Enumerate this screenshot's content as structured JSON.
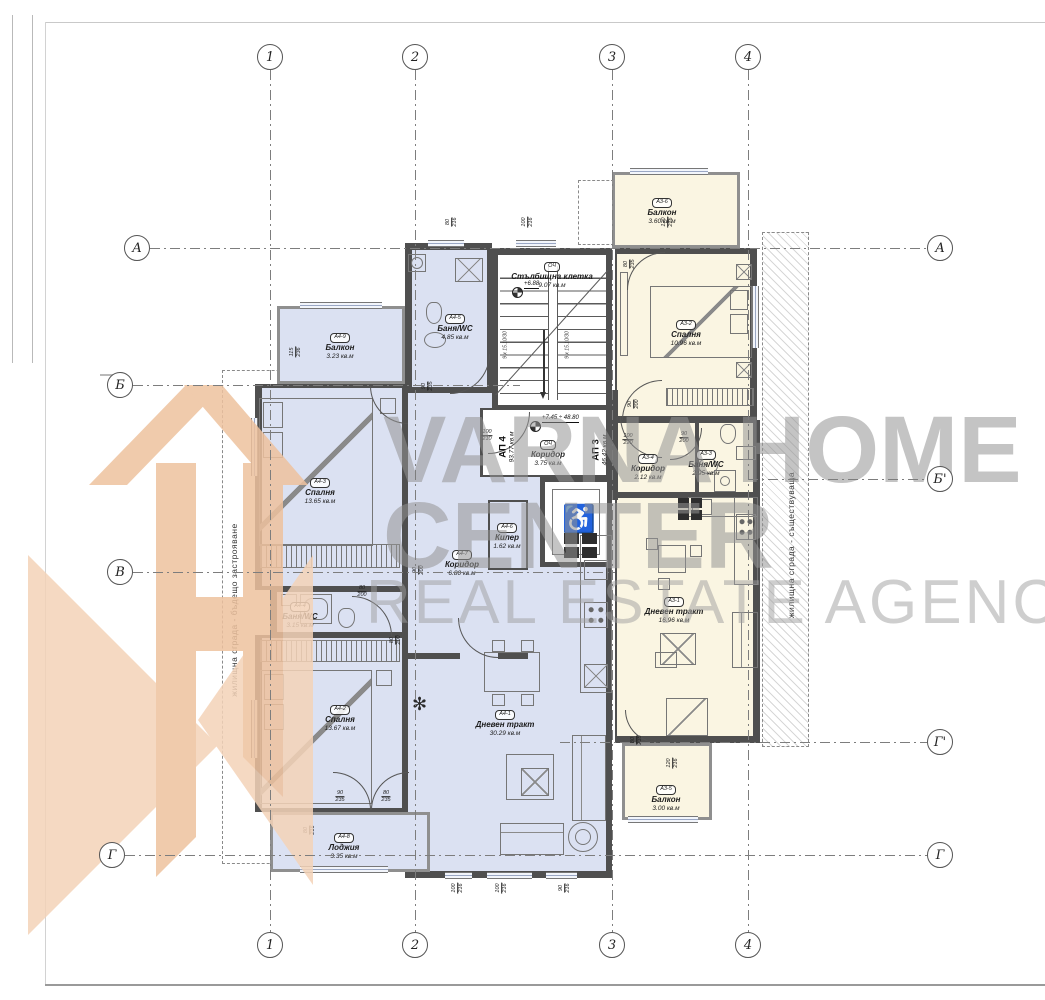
{
  "watermark": {
    "line1": "VARNA HOME",
    "line2": "CENTER",
    "line3": "REAL ESTATE AGENCY",
    "text_color": "#949494",
    "logo_color_light": "#f4d3b8",
    "logo_color_dark": "#eec29e"
  },
  "side_labels": {
    "left": "жилищна сграда - бъдещо застрояване",
    "right": "жилищна сграда - съществуваща"
  },
  "grid": {
    "cols": [
      {
        "label": "1",
        "x": 270
      },
      {
        "label": "2",
        "x": 415
      },
      {
        "label": "3",
        "x": 612
      },
      {
        "label": "4",
        "x": 748
      }
    ],
    "rows": [
      {
        "label": "А",
        "y": 248,
        "x1": 150,
        "x2": 927,
        "left": true,
        "right": true
      },
      {
        "label": "Б",
        "y": 385,
        "x1": 133,
        "x2": 520,
        "left": true,
        "right": false
      },
      {
        "label": "Б'",
        "y": 479,
        "x1": 748,
        "x2": 927,
        "left": false,
        "right": true
      },
      {
        "label": "В",
        "y": 572,
        "x1": 133,
        "x2": 615,
        "left": true,
        "right": false
      },
      {
        "label": "Г'",
        "y": 742,
        "x1": 560,
        "x2": 927,
        "left": false,
        "right": true
      },
      {
        "label": "Г",
        "y": 855,
        "x1": 125,
        "x2": 927,
        "left": true,
        "right": true
      }
    ]
  },
  "apartments": [
    {
      "id": "АП 4",
      "area": "93.77 кв.м",
      "x": 507,
      "y": 447
    },
    {
      "id": "АП 3",
      "area": "46.42 кв.м",
      "x": 600,
      "y": 450
    }
  ],
  "rooms": [
    {
      "code": "А4-5",
      "name": "Баня/WC",
      "area": "4.85 кв.м",
      "cx": 455,
      "cy": 306
    },
    {
      "code": "ОЧ",
      "name": "Стълбищна клетка",
      "area": "9.07 кв.м",
      "cx": 552,
      "cy": 254
    },
    {
      "code": "А3-6",
      "name": "Балкон",
      "area": "3.60 кв.м",
      "cx": 662,
      "cy": 190
    },
    {
      "code": "А3-2",
      "name": "Спалня",
      "area": "10.96 кв.м",
      "cx": 686,
      "cy": 312
    },
    {
      "code": "А4-9",
      "name": "Балкон",
      "area": "3.23 кв.м",
      "cx": 340,
      "cy": 325
    },
    {
      "code": "А4-3",
      "name": "Спалня",
      "area": "13.65 кв.м",
      "cx": 320,
      "cy": 470
    },
    {
      "code": "ОЧ",
      "name": "Коридор",
      "area": "3.75 кв.м",
      "cx": 548,
      "cy": 432
    },
    {
      "code": "А3-4",
      "name": "Коридор",
      "area": "2.12 кв.м",
      "cx": 648,
      "cy": 446
    },
    {
      "code": "А3-3",
      "name": "Баня/WC",
      "area": "2.95 кв.м",
      "cx": 706,
      "cy": 442
    },
    {
      "code": "А4-7",
      "name": "Коридор",
      "area": "6.80 кв.м",
      "cx": 462,
      "cy": 542
    },
    {
      "code": "А4-6",
      "name": "Килер",
      "area": "1.62 кв.м",
      "cx": 507,
      "cy": 515
    },
    {
      "code": "А3-1",
      "name": "Дневен тракт",
      "area": "16.96 кв.м",
      "cx": 674,
      "cy": 589
    },
    {
      "code": "А4-4",
      "name": "Баня/WC",
      "area": "3.15 кв.м",
      "cx": 300,
      "cy": 594
    },
    {
      "code": "А4-2",
      "name": "Спалня",
      "area": "13.67 кв.м",
      "cx": 340,
      "cy": 697
    },
    {
      "code": "А4-1",
      "name": "Дневен тракт",
      "area": "30.29 кв.м",
      "cx": 505,
      "cy": 702
    },
    {
      "code": "А4-8",
      "name": "Лоджия",
      "area": "3.35 кв.м",
      "cx": 344,
      "cy": 825
    },
    {
      "code": "А3-5",
      "name": "Балкон",
      "area": "3.00 кв.м",
      "cx": 666,
      "cy": 777
    }
  ],
  "dims": [
    {
      "t": "80",
      "b": "216",
      "x": 452,
      "y": 222,
      "r": -90
    },
    {
      "t": "100",
      "b": "216",
      "x": 528,
      "y": 222,
      "r": -90
    },
    {
      "t": "120",
      "b": "216",
      "x": 668,
      "y": 222,
      "r": -90
    },
    {
      "t": "80",
      "b": "235",
      "x": 630,
      "y": 264,
      "r": -90
    },
    {
      "t": "115",
      "b": "236",
      "x": 296,
      "y": 352,
      "r": -90
    },
    {
      "t": "90",
      "b": "235",
      "x": 428,
      "y": 386,
      "r": -90
    },
    {
      "t": "100",
      "b": "210",
      "x": 487,
      "y": 436,
      "r": 0
    },
    {
      "t": "100",
      "b": "220",
      "x": 628,
      "y": 440,
      "r": 0
    },
    {
      "t": "90",
      "b": "200",
      "x": 684,
      "y": 438,
      "r": 0
    },
    {
      "t": "90",
      "b": "200",
      "x": 634,
      "y": 404,
      "r": -90
    },
    {
      "t": "90",
      "b": "200",
      "x": 419,
      "y": 570,
      "r": -90
    },
    {
      "t": "80",
      "b": "200",
      "x": 362,
      "y": 592,
      "r": 0
    },
    {
      "t": "80",
      "b": "200",
      "x": 396,
      "y": 640,
      "r": -90
    },
    {
      "t": "90",
      "b": "235",
      "x": 340,
      "y": 797,
      "r": 0
    },
    {
      "t": "80",
      "b": "235",
      "x": 386,
      "y": 797,
      "r": 0
    },
    {
      "t": "80",
      "b": "216",
      "x": 310,
      "y": 830,
      "r": -90
    },
    {
      "t": "100",
      "b": "216",
      "x": 458,
      "y": 888,
      "r": -90
    },
    {
      "t": "100",
      "b": "216",
      "x": 502,
      "y": 888,
      "r": -90
    },
    {
      "t": "90",
      "b": "216",
      "x": 565,
      "y": 888,
      "r": -90
    },
    {
      "t": "120",
      "b": "216",
      "x": 673,
      "y": 763,
      "r": -90
    },
    {
      "t": "80",
      "b": "235",
      "x": 637,
      "y": 740,
      "r": -90
    }
  ],
  "stairs": {
    "note": "9 х 15.10/30",
    "notes_pos": [
      {
        "x": 506,
        "y": 345
      },
      {
        "x": 568,
        "y": 345
      }
    ]
  },
  "levels": [
    {
      "text": "+6.88",
      "tx": 524,
      "ty": 281,
      "mx": 512,
      "my": 287
    },
    {
      "text": "+7.45 ÷ 48.80",
      "tx": 542,
      "ty": 415,
      "mx": 530,
      "my": 421
    }
  ]
}
